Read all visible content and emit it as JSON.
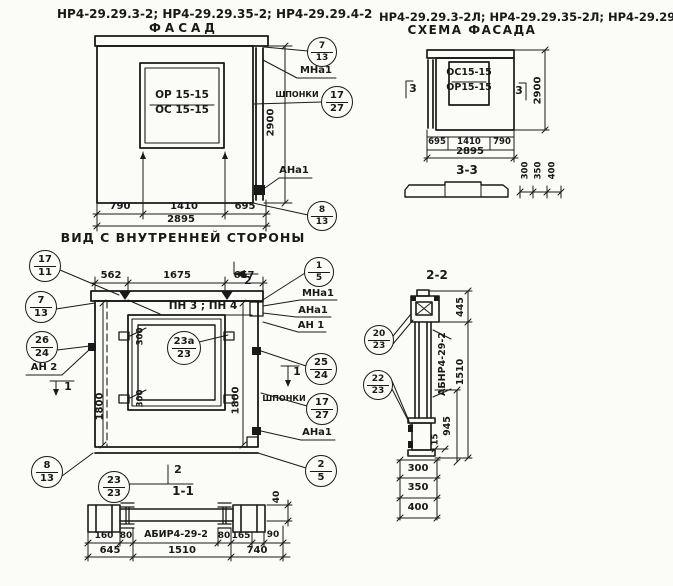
{
  "page": {
    "width": 673,
    "height": 586,
    "background": "#fbfbf8",
    "ink": "#191919"
  },
  "drawings": {
    "facade": {
      "labels": [
        {
          "id": "facade-models-title",
          "text": "НР4-29.29.3-2; НР4-29.29.35-2; НР4-29.29.4-2",
          "x": 207,
          "y": 16,
          "w": 300,
          "size": 12
        },
        {
          "id": "facade-title",
          "text": "ФАСАД",
          "x": 184,
          "y": 30,
          "w": 100,
          "size": 12,
          "sp": 4
        },
        {
          "id": "window-mark-top",
          "text": "ОР 15-15",
          "x": 182,
          "y": 97,
          "w": 72,
          "size": 10.5
        },
        {
          "id": "window-mark-bottom",
          "text": "ОС 15-15",
          "x": 182,
          "y": 112,
          "w": 72,
          "size": 10.5
        },
        {
          "id": "mna1-label",
          "text": "МНа1",
          "x": 316,
          "y": 71,
          "w": 44,
          "size": 10
        },
        {
          "id": "shponki-label",
          "text": "ШПОНКИ",
          "x": 297,
          "y": 96,
          "w": 48,
          "size": 8
        },
        {
          "id": "dim-2900",
          "text": "2900",
          "x": 272,
          "y": 122,
          "w": 36,
          "size": 10,
          "rot": -90
        },
        {
          "id": "ana1-label",
          "text": "АНа1",
          "x": 294,
          "y": 171,
          "w": 44,
          "size": 10
        },
        {
          "id": "dim-790",
          "text": "790",
          "x": 120,
          "y": 207,
          "w": 34,
          "size": 10
        },
        {
          "id": "dim-1410",
          "text": "1410",
          "x": 184,
          "y": 207,
          "w": 40,
          "size": 10
        },
        {
          "id": "dim-695",
          "text": "695",
          "x": 245,
          "y": 207,
          "w": 34,
          "size": 10
        },
        {
          "id": "dim-2895",
          "text": "2895",
          "x": 181,
          "y": 220,
          "w": 44,
          "size": 10
        }
      ],
      "callouts": [
        {
          "id": "callout-7-13",
          "top": "7",
          "bottom": "13",
          "x": 322,
          "y": 52,
          "r": 15
        },
        {
          "id": "callout-17-27",
          "top": "17",
          "bottom": "27",
          "x": 337,
          "y": 102,
          "r": 16
        },
        {
          "id": "callout-8-13",
          "top": "8",
          "bottom": "13",
          "x": 322,
          "y": 216,
          "r": 15
        }
      ]
    },
    "scheme": {
      "labels": [
        {
          "id": "scheme-models-title",
          "text": "НР4-29.29.3-2Л; НР4-29.29.35-2Л; НР4-29.29.4-2Л",
          "x": 525,
          "y": 18,
          "w": 292,
          "size": 11.5
        },
        {
          "id": "scheme-title",
          "text": "СХЕМА ФАСАДА",
          "x": 472,
          "y": 32,
          "w": 150,
          "size": 12,
          "sp": 1.5
        },
        {
          "id": "window-mark-top",
          "text": "ОС15-15",
          "x": 469,
          "y": 74,
          "w": 56,
          "size": 9.5
        },
        {
          "id": "window-mark-bottom",
          "text": "ОР15-15",
          "x": 469,
          "y": 89,
          "w": 56,
          "size": 9.5
        },
        {
          "id": "section-mark-3-left",
          "text": "3",
          "x": 413,
          "y": 90,
          "w": 14,
          "size": 11
        },
        {
          "id": "section-mark-3-right",
          "text": "3",
          "x": 519,
          "y": 92,
          "w": 14,
          "size": 11
        },
        {
          "id": "dim-2900",
          "text": "2900",
          "x": 539,
          "y": 90,
          "w": 36,
          "size": 10,
          "rot": -90
        },
        {
          "id": "dim-695",
          "text": "695",
          "x": 437,
          "y": 143,
          "w": 22,
          "size": 8.5
        },
        {
          "id": "dim-1410",
          "text": "1410",
          "x": 469,
          "y": 143,
          "w": 32,
          "size": 8.5
        },
        {
          "id": "dim-790",
          "text": "790",
          "x": 502,
          "y": 143,
          "w": 24,
          "size": 8.5
        },
        {
          "id": "dim-2895",
          "text": "2895",
          "x": 470,
          "y": 152,
          "w": 40,
          "size": 10
        },
        {
          "id": "section-3-3-title",
          "text": "3-3",
          "x": 467,
          "y": 172,
          "w": 40,
          "size": 12
        },
        {
          "id": "dim-300",
          "text": "300",
          "x": 527,
          "y": 170,
          "w": 24,
          "size": 8.5,
          "rot": -90
        },
        {
          "id": "dim-350",
          "text": "350",
          "x": 540,
          "y": 170,
          "w": 24,
          "size": 8.5,
          "rot": -90
        },
        {
          "id": "dim-400",
          "text": "400",
          "x": 554,
          "y": 170,
          "w": 24,
          "size": 8.5,
          "rot": -90
        }
      ],
      "callouts": []
    },
    "inner_view": {
      "labels": [
        {
          "id": "inner-view-title",
          "text": "ВИД С ВНУТРЕННЕЙ СТОРОНЫ",
          "x": 183,
          "y": 239,
          "w": 260,
          "size": 12.5,
          "sp": 1
        },
        {
          "id": "dim-562",
          "text": "562",
          "x": 111,
          "y": 276,
          "w": 30,
          "size": 10
        },
        {
          "id": "dim-1675",
          "text": "1675",
          "x": 177,
          "y": 276,
          "w": 36,
          "size": 10
        },
        {
          "id": "dim-657",
          "text": "657",
          "x": 244,
          "y": 276,
          "w": 30,
          "size": 10
        },
        {
          "id": "section-mark-2-top",
          "text": "2",
          "x": 248,
          "y": 282,
          "w": 14,
          "size": 11
        },
        {
          "id": "pn-plates-label",
          "text": "ПН 3 ; ПН 4",
          "x": 203,
          "y": 308,
          "w": 110,
          "size": 10.5
        },
        {
          "id": "dim-300-top",
          "text": "300",
          "x": 142,
          "y": 336,
          "w": 24,
          "size": 8.5,
          "rot": -90
        },
        {
          "id": "dim-300-bottom",
          "text": "300",
          "x": 142,
          "y": 398,
          "w": 24,
          "size": 8.5,
          "rot": -90
        },
        {
          "id": "dim-1800-left",
          "text": "1800",
          "x": 101,
          "y": 406,
          "w": 34,
          "size": 10,
          "rot": -90
        },
        {
          "id": "dim-1800-right",
          "text": "1800",
          "x": 237,
          "y": 400,
          "w": 34,
          "size": 10,
          "rot": -90
        },
        {
          "id": "mna1-label",
          "text": "МНа1",
          "x": 318,
          "y": 294,
          "w": 44,
          "size": 10
        },
        {
          "id": "ana1-label-top",
          "text": "АНа1",
          "x": 313,
          "y": 311,
          "w": 44,
          "size": 10
        },
        {
          "id": "an1-label",
          "text": "АН 1",
          "x": 311,
          "y": 326,
          "w": 40,
          "size": 10
        },
        {
          "id": "shponki-label",
          "text": "ШПОНКИ",
          "x": 284,
          "y": 400,
          "w": 48,
          "size": 8
        },
        {
          "id": "ana1-label-bottom",
          "text": "АНа1",
          "x": 317,
          "y": 433,
          "w": 44,
          "size": 10
        },
        {
          "id": "an2-label",
          "text": "АН 2",
          "x": 44,
          "y": 368,
          "w": 40,
          "size": 10
        },
        {
          "id": "section-mark-1-left",
          "text": "1",
          "x": 68,
          "y": 388,
          "w": 12,
          "size": 11
        },
        {
          "id": "section-mark-1-right",
          "text": "1",
          "x": 297,
          "y": 373,
          "w": 12,
          "size": 11
        },
        {
          "id": "section-mark-2-bottom",
          "text": "2",
          "x": 178,
          "y": 471,
          "w": 14,
          "size": 11
        },
        {
          "id": "section-1-1-title",
          "text": "1-1",
          "x": 183,
          "y": 493,
          "w": 40,
          "size": 12
        },
        {
          "id": "dim-40",
          "text": "40",
          "x": 278,
          "y": 497,
          "w": 20,
          "size": 9,
          "rot": -90
        }
      ],
      "callouts": [
        {
          "id": "callout-17-11",
          "top": "17",
          "bottom": "11",
          "x": 45,
          "y": 266,
          "r": 16
        },
        {
          "id": "callout-7-13",
          "top": "7",
          "bottom": "13",
          "x": 41,
          "y": 307,
          "r": 16
        },
        {
          "id": "callout-26-24",
          "top": "26",
          "bottom": "24",
          "x": 42,
          "y": 347,
          "r": 16
        },
        {
          "id": "callout-8-13",
          "top": "8",
          "bottom": "13",
          "x": 47,
          "y": 472,
          "r": 16
        },
        {
          "id": "callout-1-5",
          "top": "1",
          "bottom": "5",
          "x": 319,
          "y": 272,
          "r": 15
        },
        {
          "id": "callout-25-24",
          "top": "25",
          "bottom": "24",
          "x": 321,
          "y": 369,
          "r": 16
        },
        {
          "id": "callout-17-27",
          "top": "17",
          "bottom": "27",
          "x": 322,
          "y": 409,
          "r": 16
        },
        {
          "id": "callout-2-5",
          "top": "2",
          "bottom": "5",
          "x": 321,
          "y": 471,
          "r": 16
        },
        {
          "id": "callout-23a-23",
          "top": "23а",
          "bottom": "23",
          "x": 184,
          "y": 348,
          "r": 17
        },
        {
          "id": "callout-23-23",
          "top": "23",
          "bottom": "23",
          "x": 114,
          "y": 487,
          "r": 16
        }
      ]
    },
    "section_1_1": {
      "labels": [
        {
          "id": "dim-160",
          "text": "160",
          "x": 104,
          "y": 537,
          "w": 26,
          "size": 9
        },
        {
          "id": "dim-80-left",
          "text": "80",
          "x": 126,
          "y": 537,
          "w": 18,
          "size": 9
        },
        {
          "id": "beam-label",
          "text": "АБИР4-29-2",
          "x": 176,
          "y": 536,
          "w": 86,
          "size": 9.5
        },
        {
          "id": "dim-80-right",
          "text": "80",
          "x": 224,
          "y": 537,
          "w": 18,
          "size": 9
        },
        {
          "id": "dim-165",
          "text": "165",
          "x": 241,
          "y": 537,
          "w": 24,
          "size": 9
        },
        {
          "id": "dim-90",
          "text": "90",
          "x": 273,
          "y": 536,
          "w": 20,
          "size": 9
        },
        {
          "id": "dim-645",
          "text": "645",
          "x": 110,
          "y": 551,
          "w": 30,
          "size": 10
        },
        {
          "id": "dim-1510",
          "text": "1510",
          "x": 182,
          "y": 551,
          "w": 36,
          "size": 10
        },
        {
          "id": "dim-740",
          "text": "740",
          "x": 257,
          "y": 551,
          "w": 30,
          "size": 10
        }
      ],
      "callouts": []
    },
    "section_2_2": {
      "labels": [
        {
          "id": "section-2-2-title",
          "text": "2-2",
          "x": 437,
          "y": 277,
          "w": 44,
          "size": 12
        },
        {
          "id": "beam-label",
          "text": "АБНР4-29-2",
          "x": 444,
          "y": 364,
          "w": 70,
          "size": 9.5,
          "rot": -90
        },
        {
          "id": "dim-445",
          "text": "445",
          "x": 462,
          "y": 307,
          "w": 28,
          "size": 9.5,
          "rot": -90
        },
        {
          "id": "dim-1510",
          "text": "1510",
          "x": 462,
          "y": 372,
          "w": 32,
          "size": 9.5,
          "rot": -90
        },
        {
          "id": "dim-945",
          "text": "945",
          "x": 449,
          "y": 426,
          "w": 28,
          "size": 9.5,
          "rot": -90
        },
        {
          "id": "dim-15",
          "text": "15",
          "x": 437,
          "y": 439,
          "w": 16,
          "size": 8.5,
          "rot": -90
        },
        {
          "id": "dim-300",
          "text": "300",
          "x": 418,
          "y": 469,
          "w": 30,
          "size": 10
        },
        {
          "id": "dim-350",
          "text": "350",
          "x": 418,
          "y": 488,
          "w": 30,
          "size": 10
        },
        {
          "id": "dim-400",
          "text": "400",
          "x": 418,
          "y": 508,
          "w": 30,
          "size": 10
        }
      ],
      "callouts": [
        {
          "id": "callout-20-23",
          "top": "20",
          "bottom": "23",
          "x": 379,
          "y": 340,
          "r": 15
        },
        {
          "id": "callout-22-23",
          "top": "22",
          "bottom": "23",
          "x": 378,
          "y": 385,
          "r": 15
        }
      ]
    }
  }
}
